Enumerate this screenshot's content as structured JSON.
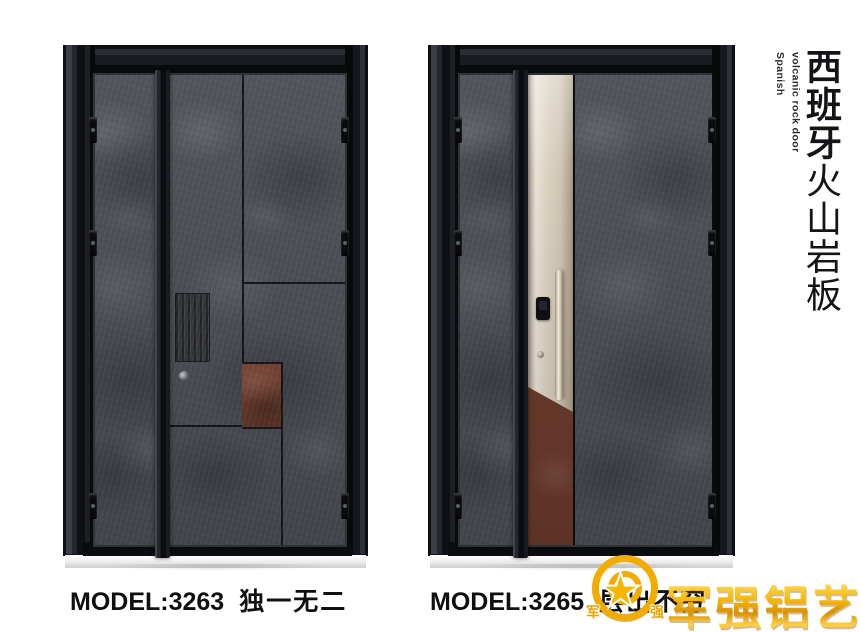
{
  "side_title": {
    "en_line1": "Spanish",
    "en_line2": "volcanic rock door",
    "zh_bold": "西班牙",
    "zh_rest": "火山岩板"
  },
  "products": [
    {
      "model": "MODEL:3263",
      "tagline": "独一无二"
    },
    {
      "model": "MODEL:3265",
      "tagline": "层出不穷"
    }
  ],
  "brand": {
    "name": "军强铝艺",
    "emblem": {
      "left_char": "军",
      "right_char": "强",
      "star_icon": "★"
    },
    "gold": "#f2ae00"
  },
  "colors": {
    "background": "#ffffff",
    "frame_dark": "#17181d",
    "rock_base": "#4b4e55",
    "seam": "#141519",
    "rust": "#7b4533",
    "champagne": "#d8cfbe",
    "caption_text": "#101010"
  }
}
